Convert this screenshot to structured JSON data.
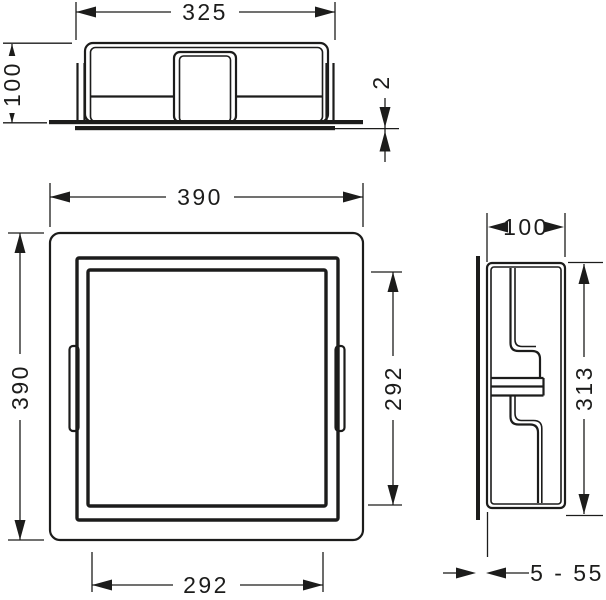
{
  "drawing_type": "technical-dimension-drawing",
  "views": {
    "top": {
      "label": "top-view",
      "width": "325",
      "height": "100",
      "trim_thickness": "2"
    },
    "front": {
      "label": "front-view",
      "outer_width": "390",
      "outer_height": "390",
      "inner_height": "292",
      "inner_width": "292"
    },
    "side": {
      "label": "side-view",
      "depth": "100",
      "inner_height": "313",
      "tile_range": "5 - 55"
    }
  },
  "colors": {
    "line": "#1c1c1b",
    "background": "#ffffff"
  }
}
